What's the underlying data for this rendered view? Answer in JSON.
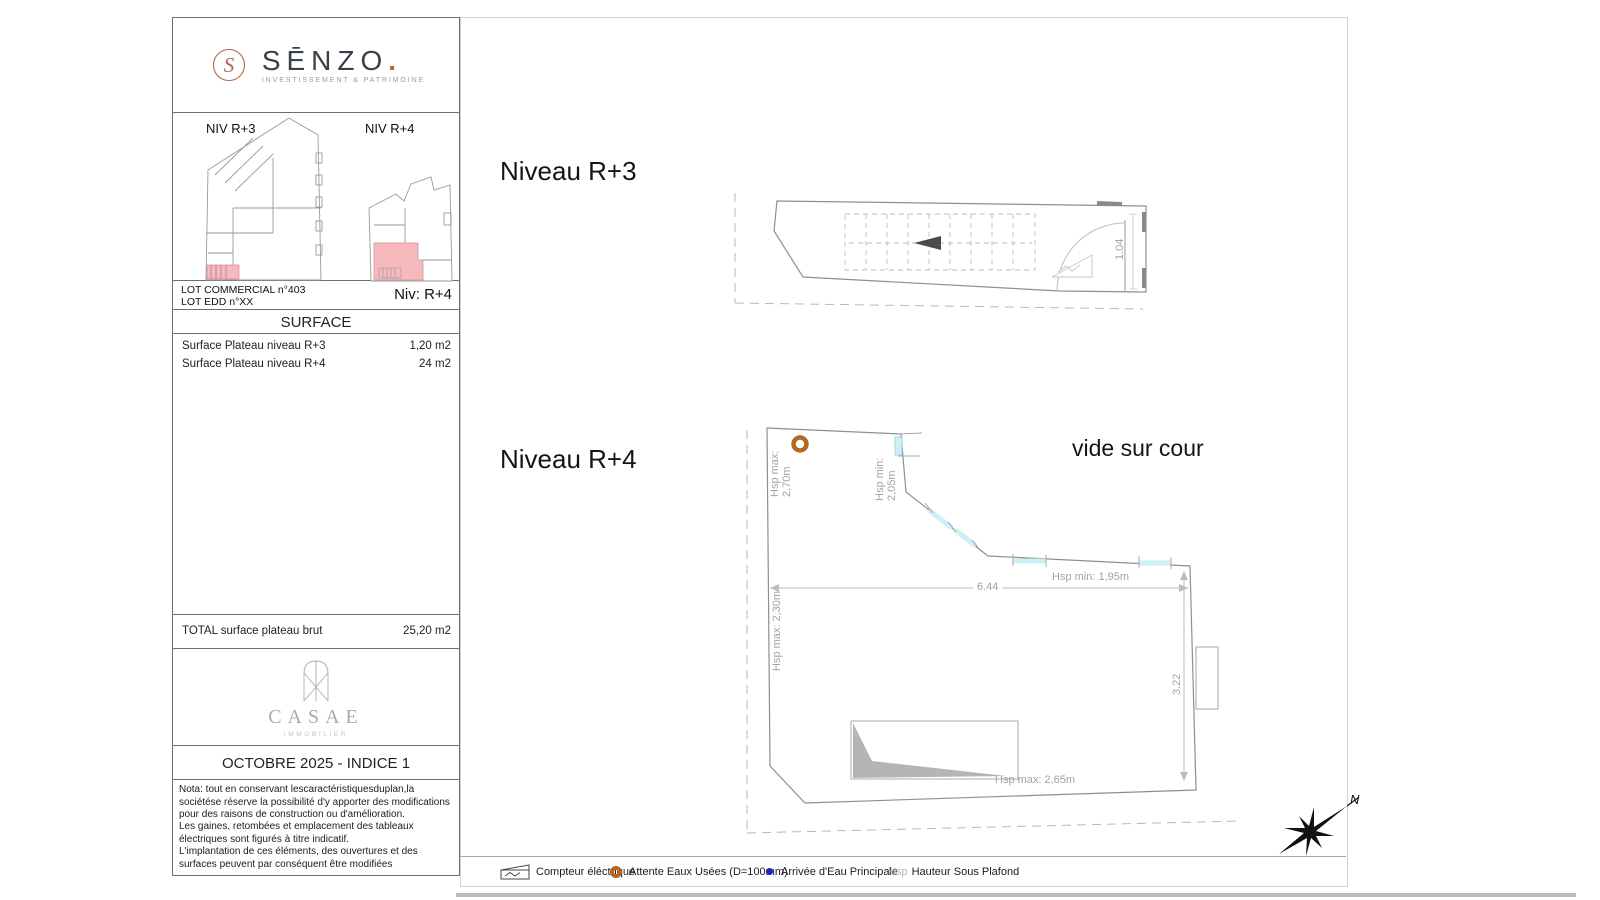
{
  "colors": {
    "accent_copper": "#b2654c",
    "highlight_pink": "#f5b9be",
    "window_cyan": "#cdeff6",
    "waste_orange": "#b5681f",
    "water_blue": "#2121c8",
    "casae_sage": "#a3b2a5"
  },
  "sidebar": {
    "logo": {
      "brand": "SĒNZO",
      "dot": ".",
      "tagline": "INVESTISSEMENT & PATRIMOINE"
    },
    "miniplans": {
      "left_label": "NIV R+3",
      "right_label": "NIV R+4"
    },
    "lot": {
      "line1": "LOT COMMERCIAL n°403",
      "line2": "LOT EDD n°XX",
      "level": "Niv: R+4"
    },
    "surface": {
      "header": "SURFACE",
      "rows": [
        {
          "label": "Surface Plateau niveau R+3",
          "value": "1,20 m2"
        },
        {
          "label": "Surface Plateau niveau R+4",
          "value": "24 m2"
        }
      ],
      "total_label": "TOTAL surface plateau brut",
      "total_value": "25,20 m2"
    },
    "casae": {
      "brand": "CASAE",
      "tagline": "IMMOBILIER"
    },
    "issue": "OCTOBRE 2025 - INDICE 1",
    "nota": {
      "line1": "Nota: tout en conservant lescaractéristiquesduplan,la sociétése réserve la possibilité d'y apporter des modifications pour des raisons de construction ou d'amélioration.",
      "line2": "Les gaines, retombées et emplacement des tableaux électriques sont figurés à titre indicatif.",
      "line3": "L'implantation de ces éléments, des ouvertures et des surfaces peuvent par conséquent être modifiées"
    }
  },
  "plans": {
    "r3": {
      "title": "Niveau R+3",
      "door_dim": "1.04"
    },
    "r4": {
      "title": "Niveau R+4",
      "vide_label": "vide sur cour",
      "hsp_max_270": "Hsp max:\n2,70m",
      "hsp_min_205": "Hsp min:\n2,05m",
      "hsp_max_230": "Hsp max: 2,30m",
      "hsp_min_195": "Hsp min: 1,95m",
      "hsp_max_265": "Hsp max: 2,65m",
      "dim_width": "6.44",
      "dim_height": "3.22"
    }
  },
  "legend": {
    "items": [
      {
        "icon": "electric-meter",
        "label": "Compteur éléctrique"
      },
      {
        "icon": "waste-water",
        "label": "Attente Eaux Usées (D=100mm)"
      },
      {
        "icon": "water-main",
        "label": "Arrivée d'Eau Principale"
      },
      {
        "icon": "hsp",
        "prefix": "Hsp",
        "label": "Hauteur Sous Plafond"
      }
    ]
  },
  "compass": {
    "north": "N"
  }
}
